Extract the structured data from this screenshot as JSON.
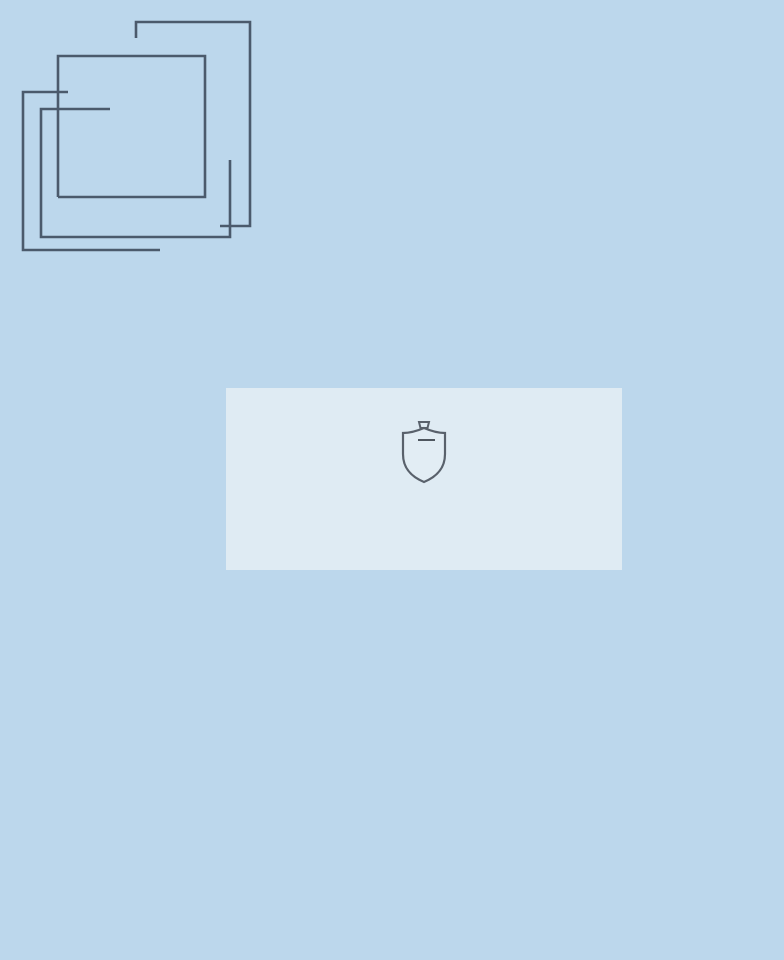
{
  "logo": {
    "line1": "FOUR",
    "line2": "ROOMS",
    "tagline": "Real estate"
  },
  "band": {
    "subtitle": "КЛУБНЫЙ ДОМ",
    "title": "СВЕТЛАНОВСКИЙ"
  },
  "emblem": {
    "monogram": "45"
  },
  "icons": {
    "airplane": "✈"
  },
  "colors": {
    "sky_top": "#a6cbe8",
    "sky_bottom": "#dcebf6",
    "stone_cream": "#e8e1d4",
    "glass_blue": "#bccfdf",
    "gold_accent": "#d2a14c",
    "gold_deep": "#b9852f",
    "logo_slate": "#47566a",
    "title_gray": "#3b3f44"
  }
}
